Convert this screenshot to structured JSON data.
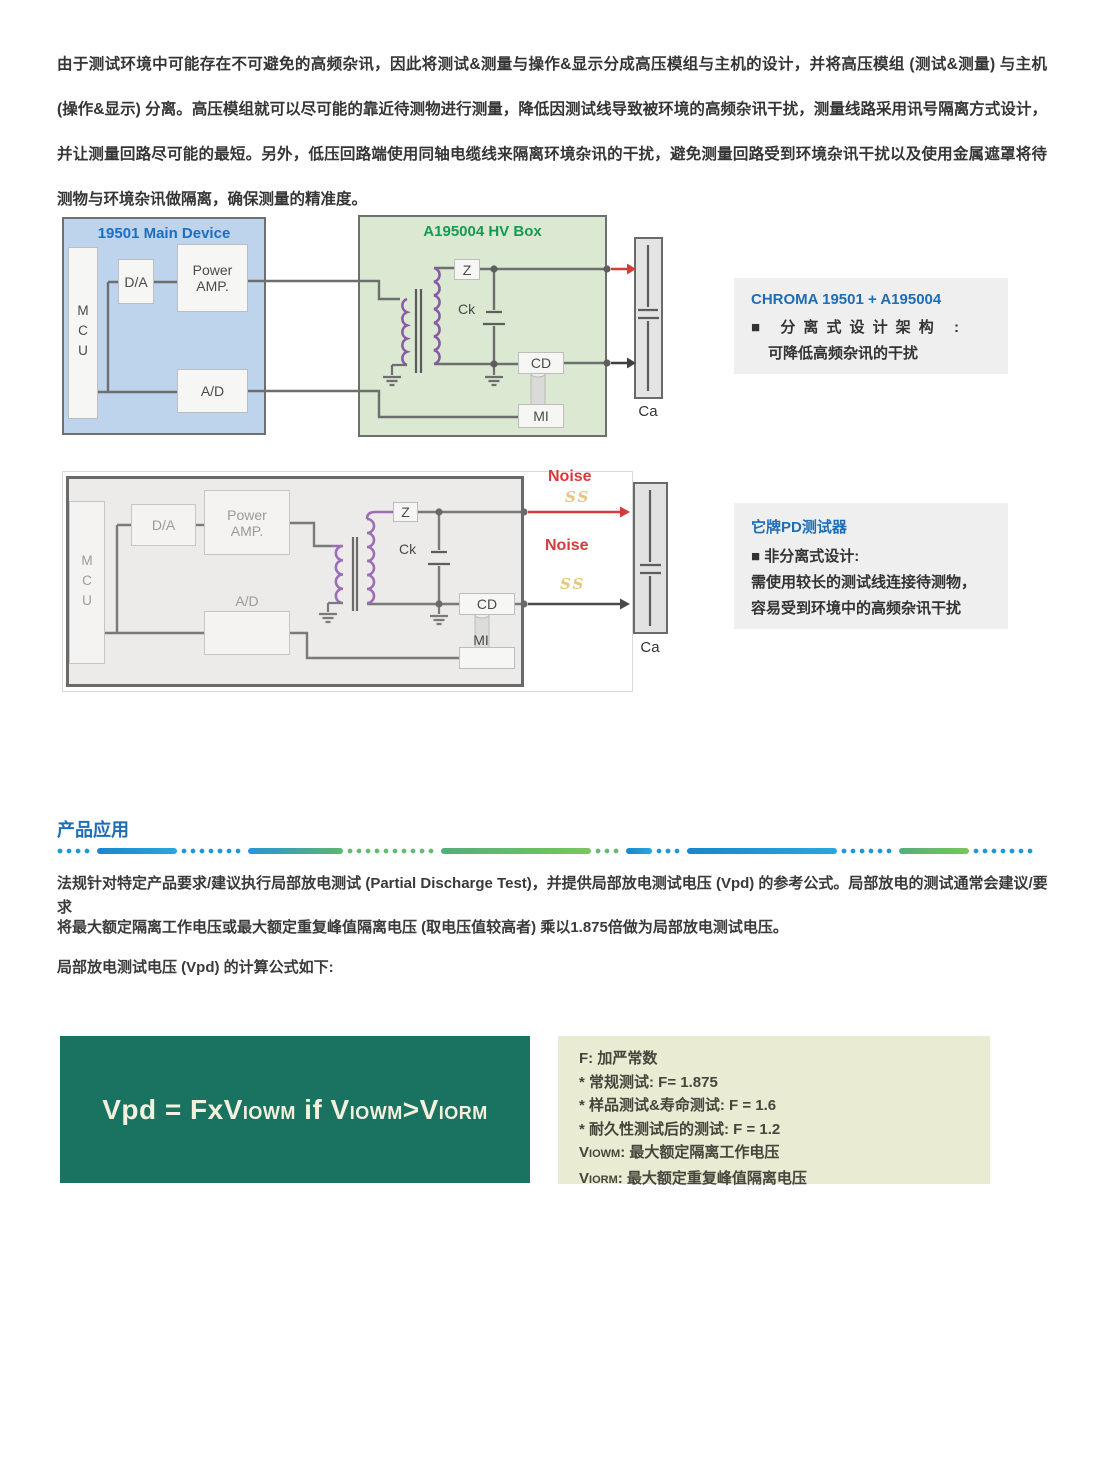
{
  "intro": {
    "text": "由于测试环境中可能存在不可避免的高频杂讯，因此将测试&测量与操作&显示分成高压模组与主机的设计，并将高压模组 (测试&测量) 与主机 (操作&显示) 分离。高压模组就可以尽可能的靠近待测物进行测量，降低因测试线导致被环境的高频杂讯干扰，测量线路采用讯号隔离方式设计，并让测量回路尽可能的最短。另外，低压回路端使用同轴电缆线来隔离环境杂讯的干扰，避免测量回路受到环境杂讯干扰以及使用金属遮罩将待测物与环境杂讯做隔离，确保测量的精准度。"
  },
  "figure1": {
    "main_device": {
      "title": "19501 Main Device",
      "mcu": "MCU",
      "da": "D/A",
      "power_amp": "Power AMP.",
      "ad": "A/D"
    },
    "hv_box": {
      "title": "A195004 HV Box",
      "z": "Z",
      "ck": "Ck",
      "cd": "CD",
      "mi": "MI"
    },
    "ca": "Ca"
  },
  "note1": {
    "title": "CHROMA 19501 + A195004",
    "line1": "■ 分离式设计架构 :",
    "line2": "可降低高频杂讯的干扰"
  },
  "figure2": {
    "mcu": "MCU",
    "da": "D/A",
    "power_amp": "Power AMP.",
    "ad": "A/D",
    "z": "Z",
    "ck": "Ck",
    "cd": "CD",
    "mi": "MI",
    "ca": "Ca",
    "noise_top": "Noise",
    "noise_mid": "Noise",
    "squiggle_top": "SS",
    "squiggle_bottom": "SS"
  },
  "note2": {
    "title": "它牌PD测试器",
    "line1": "■ 非分离式设计:",
    "line2": "需使用较长的测试线连接待测物，",
    "line3": "容易受到环境中的高频杂讯干扰"
  },
  "applications": {
    "section_title": "产品应用",
    "line1": "法规针对特定产品要求/建议执行局部放电测试 (Partial Discharge Test)，并提供局部放电测试电压 (Vpd) 的参考公式。局部放电的测试通常会建议/要求",
    "line2": "将最大额定隔离工作电压或最大额定重复峰值隔离电压 (取电压值较高者) 乘以1.875倍做为局部放电测试电压。",
    "line3": "局部放电测试电压 (Vpd) 的计算公式如下:"
  },
  "formula": {
    "pre": "Vpd = FxV",
    "sub1": "IOWM",
    "mid": " if V",
    "sub2": "IOWM",
    "gt": ">V",
    "sub3": "IORM"
  },
  "legend": {
    "line1": "F: 加严常数",
    "line2": "* 常规测试: F= 1.875",
    "line3": "* 样品测试&寿命测试: F = 1.6",
    "line4": "* 耐久性测试后的测试: F = 1.2",
    "viowm_v": "V",
    "viowm_sub": "IOWM",
    "viowm_rest": ": 最大额定隔离工作电压",
    "viorm_v": "V",
    "viorm_sub": "IORM",
    "viorm_rest": ": 最大额定重复峰值隔离电压"
  },
  "colors": {
    "accent_blue": "#1e6fc0",
    "accent_green": "#149a52",
    "noise_red": "#d63b3b",
    "formula_green_bg": "#1a7360",
    "legend_bg": "#e9ecd3",
    "note_bg": "#efefef",
    "coil_purple": "#8a5aa8"
  }
}
